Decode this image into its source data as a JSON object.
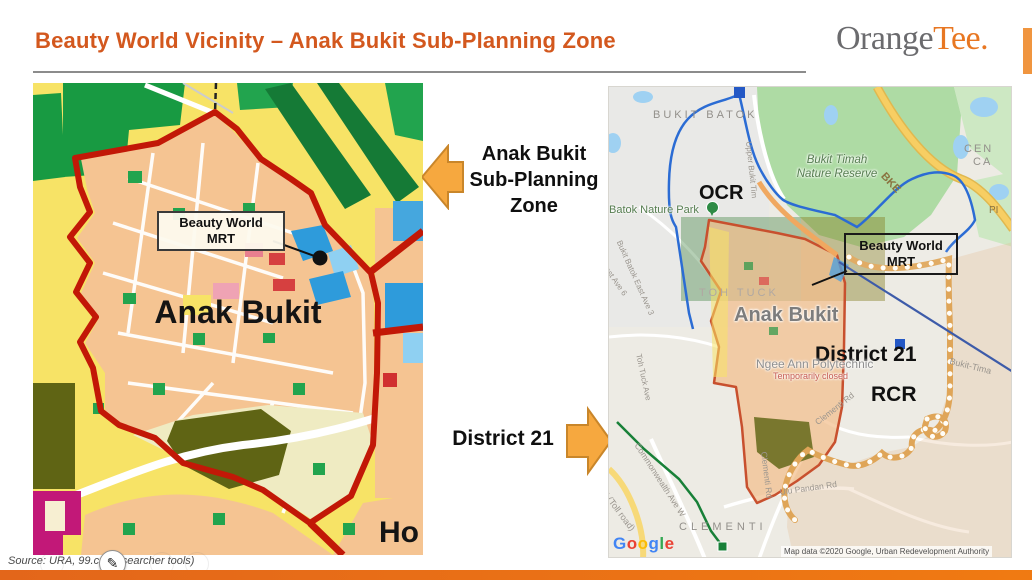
{
  "slide": {
    "title": "Beauty World Vicinity – Anak Bukit Sub-Planning Zone",
    "logo_gray": "Orange",
    "logo_orange": "Tee",
    "logo_period": ".",
    "source_note": "Source: URA, 99.co (researcher tools)",
    "brand_orange": "#E87722",
    "title_color": "#D3581E",
    "bottom_bar_color": "#EC7114",
    "arrow_color": "#F6A83F"
  },
  "callouts": {
    "left_line1": "Anak Bukit",
    "left_line2": "Sub-Planning",
    "left_line3": "Zone",
    "right_label": "District 21"
  },
  "left_map": {
    "mrt_box_line1": "Beauty World",
    "mrt_box_line2": "MRT",
    "area_label": "Anak Bukit",
    "edge_label": "Ho",
    "zone_boundary_color": "#C21807"
  },
  "right_map": {
    "region_bukit_batok": "BUKIT BATOK",
    "nature_reserve_line1": "Bukit Timah",
    "nature_reserve_line2": "Nature Reserve",
    "road_bke": "BKE",
    "corner_line1": "CEN",
    "corner_line2": "CA",
    "label_ocr": "OCR",
    "park": "Batok Nature Park",
    "road_bb_east3": "Bukit Batok East Ave 3",
    "road_east6": "East Ave 6",
    "road_upper_bukit_timah": "Upper Bukit Tim",
    "region_toh_tuck": "TOH TUCK",
    "area_label": "Anak Bukit",
    "mrt_box_line1": "Beauty World",
    "mrt_box_line2": "MRT",
    "label_district": "District 21",
    "label_rcr": "RCR",
    "poi_ngee_ann": "Ngee Ann Polytechnic",
    "poi_ngee_ann_status": "Temporarily closed",
    "road_toh_tuck_ave": "Toh Tuck Ave",
    "road_commonwealth": "Commonwealth Ave W",
    "road_aye": "AYE (Toll road)",
    "region_clementi": "CLEMENTI",
    "road_ulu_pandan": "Ulu Pandan Rd",
    "road_clementi_rd_v": "Clementi Rd",
    "road_clementi_rd_d": "Clementi Rd",
    "road_bukit_timah": "Bukit-Tima",
    "road_pi": "PI",
    "google_letters": [
      "G",
      "o",
      "o",
      "g",
      "l",
      "e"
    ],
    "attribution": "Map data ©2020 Google, Urban Redevelopment Authority"
  }
}
